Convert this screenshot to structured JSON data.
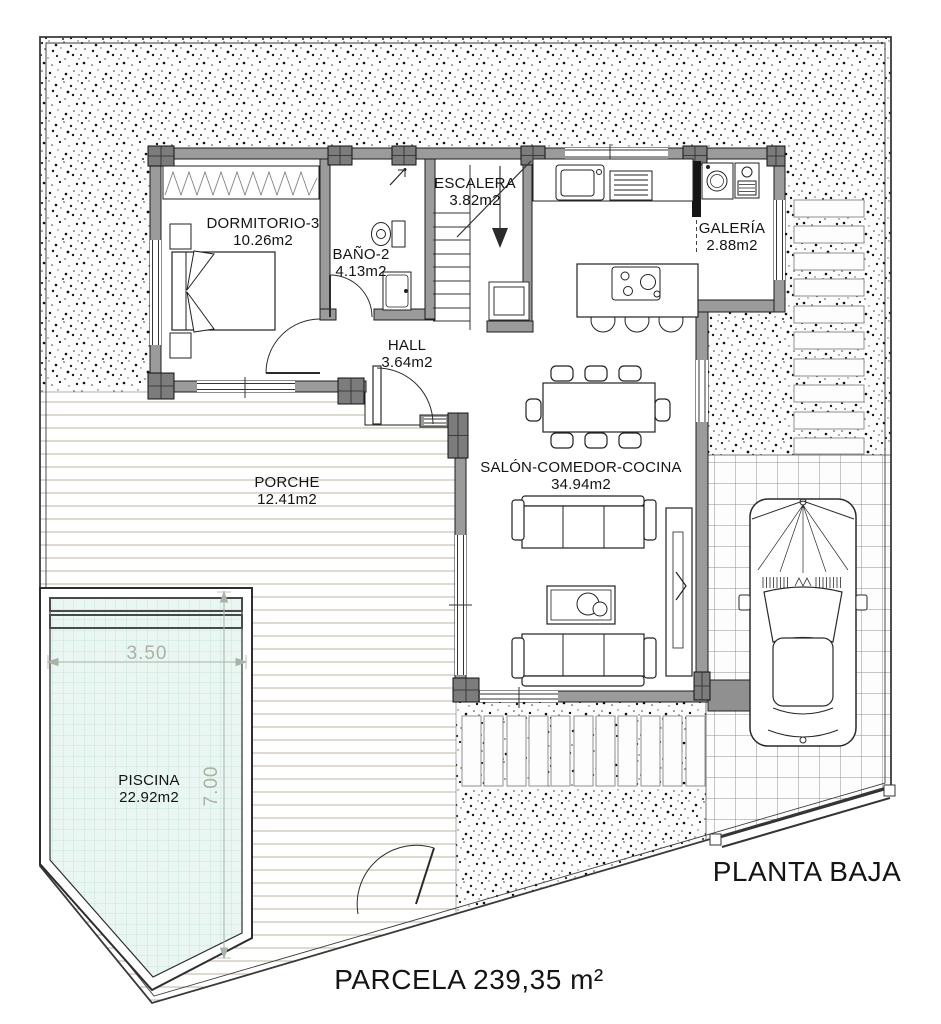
{
  "plan": {
    "title": "PLANTA BAJA",
    "parcel_label": "PARCELA 239,35 m²"
  },
  "rooms": {
    "dormitorio": {
      "name": "DORMITORIO-3",
      "area": "10.26m2"
    },
    "bano": {
      "name": "BAÑO-2",
      "area": "4.13m2"
    },
    "escalera": {
      "name": "ESCALERA",
      "area": "3.82m2"
    },
    "galeria": {
      "name": "GALERÍA",
      "area": "2.88m2"
    },
    "hall": {
      "name": "HALL",
      "area": "3.64m2"
    },
    "salon": {
      "name": "SALÓN-COMEDOR-COCINA",
      "area": "34.94m2"
    },
    "porche": {
      "name": "PORCHE",
      "area": "12.41m2"
    },
    "piscina": {
      "name": "PISCINA",
      "area": "22.92m2"
    }
  },
  "pool_dimensions": {
    "width_m": "3.50",
    "length_m": "7.00"
  },
  "colors": {
    "wall_fill": "#9b9b9b",
    "pillar_fill": "#7c7c7c",
    "pool_water": "#e9f6f2",
    "dimension_text": "#a9b2a6",
    "line": "#1c1c1c"
  }
}
